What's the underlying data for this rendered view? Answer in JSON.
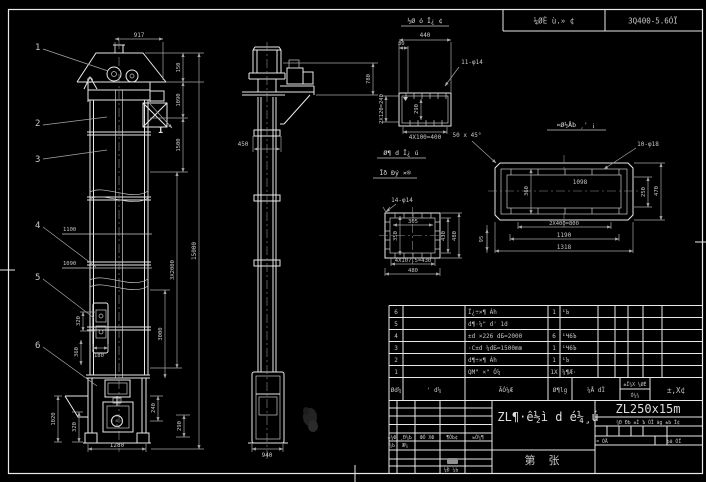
{
  "colors": {
    "background": "#000000",
    "line": "#e9e9e9",
    "dim": "#a6a6a6",
    "text": "#c6c6c6"
  },
  "top_bar": {
    "cell_a": "¼ØÈ ù.» ¢",
    "cell_b": "3Q400-5.6ÓÏ"
  },
  "front_view": {
    "balloons": [
      "1",
      "2",
      "3",
      "4",
      "5",
      "6"
    ],
    "section_mark": "I",
    "dims": {
      "width_top": "917",
      "h150": "150",
      "h1090": "1090",
      "h1500": "1500",
      "h3x2000": "3X2000",
      "h3000": "3000",
      "total": "15000",
      "h240": "240",
      "h290": "290",
      "level_upper": "1100",
      "level_lower": "1090",
      "bucket_pitch": "320",
      "bucket_h": "360",
      "bucket_w": "180",
      "boot_h": "1020",
      "boot_flange": "320",
      "width_bottom": "1280"
    }
  },
  "side_view": {
    "dims": {
      "depth": "450",
      "head_h": "780",
      "width_bottom": "940"
    }
  },
  "detail_channel": {
    "title": "½Ø ó Ī¿ ¢",
    "holes": "11-φ14",
    "dims": {
      "w": "440",
      "edge": "30",
      "rows": "2X120=240",
      "inner": "290",
      "pitch": "4X100=400"
    }
  },
  "detail_plate": {
    "title": "¤Ø½Åb ¸' ¡",
    "chamfer": "50 x 45°",
    "holes": "10-φ18",
    "dims": {
      "inner_l": "1098",
      "inner_w": "360",
      "r250": "250",
      "r470": "470",
      "pitch": "2X400=800",
      "span": "1190",
      "outer": "1318",
      "edge": "95"
    }
  },
  "detail_flange": {
    "title_1": "Ø¶ d Ī¿ ú",
    "title_2": "Īð Ðý ×®",
    "holes": "14-φ14",
    "dims": {
      "inner_w": "305",
      "inner_h": "350",
      "r430": "430",
      "r480": "480",
      "pitch": "4X107.5=430",
      "outer": "480"
    }
  },
  "bom": {
    "headers": {
      "no": "Ød¼",
      "code": "' d¼",
      "name": "ÃÓ¼Æ",
      "qty": "Ø¶lg",
      "material": "¼Å dÏ",
      "weight_top": "±Ï¼Х ¼ØÈ",
      "weight_bottom": "Ó¼¼",
      "remark": "±,Х¢"
    },
    "rows": [
      {
        "no": "6",
        "name": "Ï¿÷×¶ Àh",
        "qty": "1",
        "material": "¹Ъ"
      },
      {
        "no": "5",
        "name": "d¶·¼\" d' 1d",
        "qty": "",
        "material": ""
      },
      {
        "no": "4",
        "name": "±d ×226 dБ=2000",
        "qty": "6",
        "material": "¹Ч6Ъ"
      },
      {
        "no": "3",
        "name": "·C±d ¼dБ=1500mm",
        "qty": "1",
        "material": "¹Ч6Ъ"
      },
      {
        "no": "2",
        "name": "d¶÷×¶ Àh",
        "qty": "1",
        "material": "¹Ъ"
      },
      {
        "no": "1",
        "name": "QМ\" ×\" Ó¼",
        "qty": "1Х",
        "material": "¼¶Æ·"
      }
    ]
  },
  "title_block": {
    "rev_headers": [
      "±¼Ф",
      "¸Ð¼Ь",
      "ФÓ ХФ",
      "¶ÓЬ¢",
      "ьÓ¼¶"
    ],
    "rev_row2": [
      "¼Ь",
      "Ж¼"
    ],
    "approver_label": "¼Ð ¼Ь",
    "drawing_name": "ZL¶·ê½ì d é¼¸ú",
    "sheet_char_1": "第",
    "sheet_char_2": "张",
    "model": "ZL250x15m",
    "strip": "¼Ð ÐЬ ±Ì Ъ ÓÏ àg ±Ь Ĭ¢",
    "scale_left": "= ÓÅ",
    "scale_right": "Ьã ÓÏ"
  }
}
